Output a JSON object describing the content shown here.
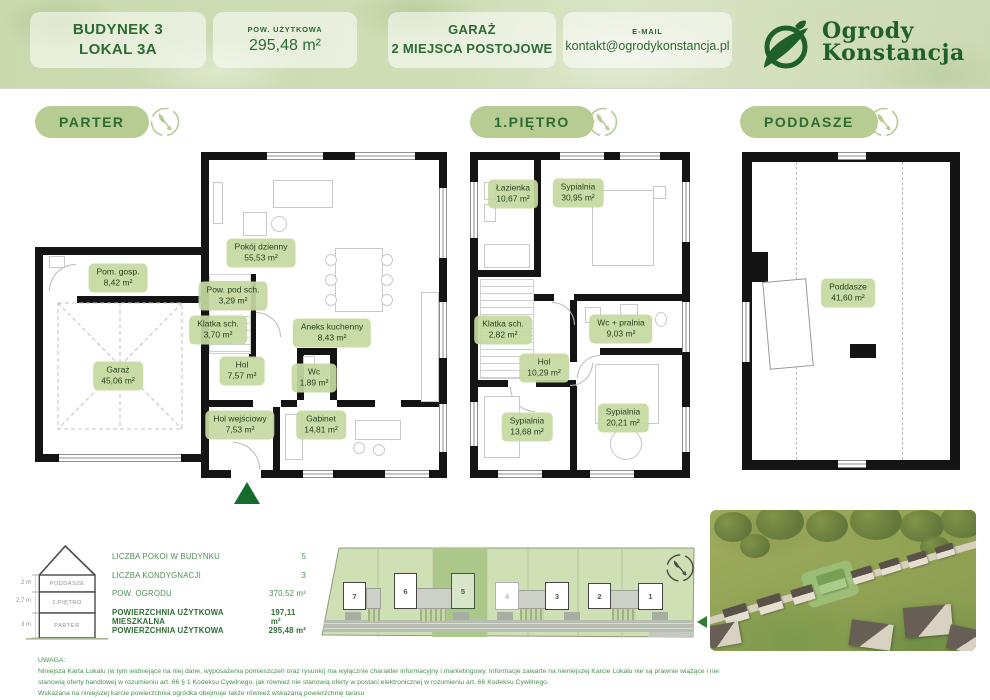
{
  "header": {
    "building": {
      "line1": "BUDYNEK 3",
      "line2": "LOKAL 3A"
    },
    "area": {
      "label": "POW. UŻYTKOWA",
      "value": "295,48 m²"
    },
    "garage": {
      "line1": "GARAŻ",
      "line2": "2 MIEJSCA POSTOJOWE"
    },
    "email": {
      "label": "E-MAIL",
      "value": "kontakt@ogrodykonstancja.pl"
    },
    "logo": {
      "line1": "Ogrody",
      "line2": "Konstancja"
    }
  },
  "sections": {
    "parter": "PARTER",
    "pietro": "1.PIĘTRO",
    "poddasze": "PODDASZE"
  },
  "floors": {
    "parter": {
      "rooms": [
        {
          "name": "Pokój dzienny",
          "area": "55,53 m²"
        },
        {
          "name": "Pow. pod sch.",
          "area": "3,29  m²"
        },
        {
          "name": "Klatka sch.",
          "area": "3,70 m²"
        },
        {
          "name": "Aneks kuchenny",
          "area": "8,43 m²"
        },
        {
          "name": "Pom. gosp.",
          "area": "8,42 m²"
        },
        {
          "name": "Garaż",
          "area": "45,06 m²"
        },
        {
          "name": "Hol",
          "area": "7,57 m²"
        },
        {
          "name": "Wc",
          "area": "1,89 m²"
        },
        {
          "name": "Hol wejściowy",
          "area": "7,53 m²"
        },
        {
          "name": "Gabinet",
          "area": "14,81 m²"
        }
      ]
    },
    "pietro": {
      "rooms": [
        {
          "name": "Łazienka",
          "area": "10,67 m²"
        },
        {
          "name": "Sypialnia",
          "area": "30,95 m²"
        },
        {
          "name": "Klatka sch.",
          "area": "2,82 m²"
        },
        {
          "name": "Wc + pralnia",
          "area": "9,03 m²"
        },
        {
          "name": "Hol",
          "area": "10,29 m²"
        },
        {
          "name": "Sypialnia",
          "area": "13,68 m²"
        },
        {
          "name": "Sypialnia",
          "area": "20,21 m²"
        }
      ]
    },
    "poddasze": {
      "rooms": [
        {
          "name": "Poddasze",
          "area": "41,60 m²"
        }
      ]
    }
  },
  "summary": {
    "section_floors": [
      "PODDASZE",
      "1.PIĘTRO",
      "PARTER"
    ],
    "floor_heights": [
      "2 m",
      "2,7 m",
      "3 m"
    ],
    "stats": [
      {
        "label": "LICZBA POKOI W BUDYNKU",
        "value": "5"
      },
      {
        "label": "LICZBA KONDYGNACJI",
        "value": "3"
      },
      {
        "label": "POW. OGRODU",
        "value": "370,52 m²"
      },
      {
        "label": "POWIERZCHNIA UŻYTKOWA MIESZKALNA",
        "value": "197,11 m²"
      },
      {
        "label": "POWIERZCHNIA UŻYTKOWA",
        "value": "295,48 m²"
      }
    ]
  },
  "siteplan": {
    "plots": [
      "7",
      "6",
      "5",
      "4",
      "3",
      "2",
      "1"
    ],
    "highlighted_plot": "5"
  },
  "note": {
    "title": "UWAGA:",
    "line1": "Niniejsza Karta Lokalu (w tym widniejące na niej dane, wyposażenia pomieszczeń oraz rysunki) ma wyłącznie charakter informacyjny i marketingowy. Informacje zawarte na nieniejszej Karcie Lokalu nie są prawnie wiążące i nie",
    "line2": "stanowią oferty handlowej w rozumieniu art. 66 § 1 Kodeksu Cywilnego, jak również nie stanowią oferty w postaci elektronicznej w rozumieniu art. 66 Kodeksu Cywilnego.",
    "line3": "Wskazana na niniejszej karcie powierzchnia ogródka obejmuje także również wskazaną powierzchnię tarasu"
  },
  "colors": {
    "accent": "#2d6b33",
    "pill": "#b6cc93",
    "label_bg": "#c5d9a0",
    "wall": "#141414",
    "highlight_plot": "#abc88a"
  }
}
